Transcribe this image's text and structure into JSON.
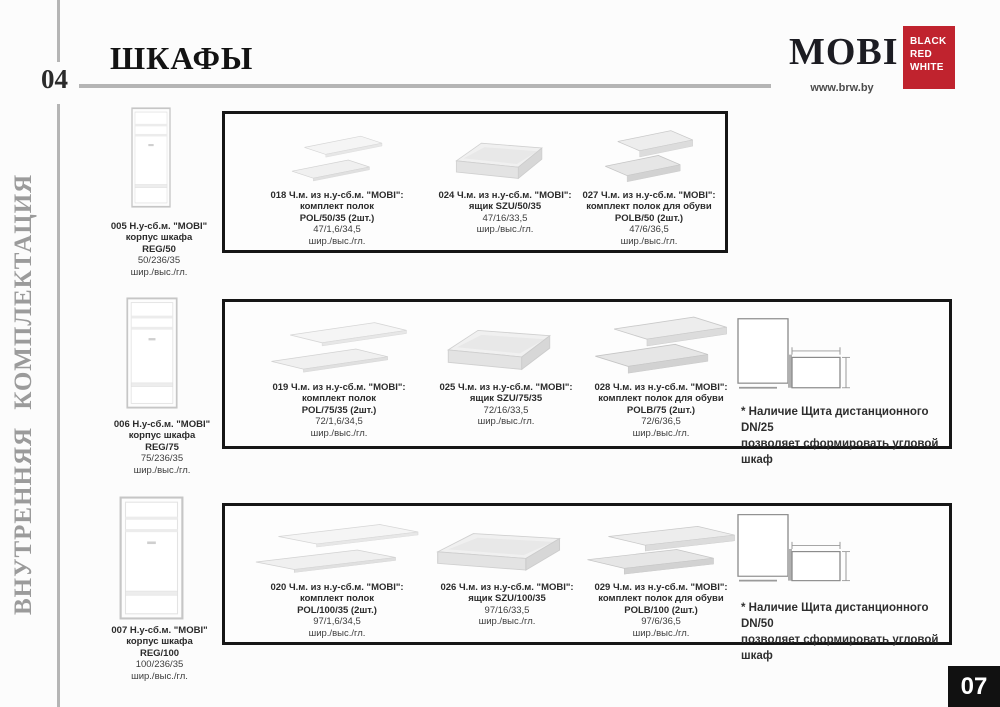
{
  "page": {
    "left_number": "04",
    "right_number": "07",
    "title": "ШКАФЫ",
    "sidebar": "ВНУТРЕННЯЯ КОМПЛЕКТАЦИЯ"
  },
  "brand": {
    "name": "MOBI",
    "website": "www.brw.by",
    "logo": {
      "line1": "BLACK",
      "line2": "RED",
      "line3": "WHITE"
    }
  },
  "colors": {
    "brand_red": "#c0232e",
    "page_box_black": "#111111",
    "line_gray": "#b5b5b5"
  },
  "rows": [
    {
      "wardrobe": {
        "code": "005 Н.у-сб.м. \"MOBI\"",
        "name": "корпус шкафа",
        "model": "REG/50",
        "dims": "50/236/35",
        "dims_label": "шир./выс./гл."
      },
      "items": [
        {
          "code": "018 Ч.м. из н.у-сб.м. \"MOBI\":",
          "name": "комплект полок",
          "model": "POL/50/35 (2шт.)",
          "dims": "47/1,6/34,5",
          "dims_label": "шир./выс./гл."
        },
        {
          "code": "024 Ч.м. из н.у-сб.м. \"MOBI\":",
          "name": "ящик SZU/50/35",
          "dims": "47/16/33,5",
          "dims_label": "шир./выс./гл."
        },
        {
          "code": "027 Ч.м. из н.у-сб.м. \"MOBI\":",
          "name": "комплект полок для обуви",
          "model": "POLB/50 (2шт.)",
          "dims": "47/6/36,5",
          "dims_label": "шир./выс./гл."
        }
      ]
    },
    {
      "wardrobe": {
        "code": "006 Н.у-сб.м. \"MOBI\"",
        "name": "корпус шкафа",
        "model": "REG/75",
        "dims": "75/236/35",
        "dims_label": "шир./выс./гл."
      },
      "items": [
        {
          "code": "019 Ч.м. из н.у-сб.м. \"MOBI\":",
          "name": "комплект полок",
          "model": "POL/75/35 (2шт.)",
          "dims": "72/1,6/34,5",
          "dims_label": "шир./выс./гл."
        },
        {
          "code": "025 Ч.м. из н.у-сб.м. \"MOBI\":",
          "name": "ящик SZU/75/35",
          "dims": "72/16/33,5",
          "dims_label": "шир./выс./гл."
        },
        {
          "code": "028 Ч.м. из н.у-сб.м. \"MOBI\":",
          "name": "комплект полок для обуви",
          "model": "POLB/75 (2шт.)",
          "dims": "72/6/36,5",
          "dims_label": "шир./выс./гл."
        }
      ],
      "note_line1": "* Наличие Щита дистанционного DN/25",
      "note_line2": "позволяет сформировать угловой шкаф"
    },
    {
      "wardrobe": {
        "code": "007 Н.у-сб.м. \"MOBI\"",
        "name": "корпус шкафа",
        "model": "REG/100",
        "dims": "100/236/35",
        "dims_label": "шир./выс./гл."
      },
      "items": [
        {
          "code": "020 Ч.м. из н.у-сб.м. \"MOBI\":",
          "name": "комплект полок",
          "model": "POL/100/35 (2шт.)",
          "dims": "97/1,6/34,5",
          "dims_label": "шир./выс./гл."
        },
        {
          "code": "026 Ч.м. из н.у-сб.м. \"MOBI\":",
          "name": "ящик SZU/100/35",
          "dims": "97/16/33,5",
          "dims_label": "шир./выс./гл."
        },
        {
          "code": "029 Ч.м. из н.у-сб.м. \"MOBI\":",
          "name": "комплект полок для обуви",
          "model": "POLB/100 (2шт.)",
          "dims": "97/6/36,5",
          "dims_label": "шир./выс./гл."
        }
      ],
      "note_line1": "* Наличие Щита дистанционного DN/50",
      "note_line2": "позволяет сформировать угловой шкаф"
    }
  ]
}
